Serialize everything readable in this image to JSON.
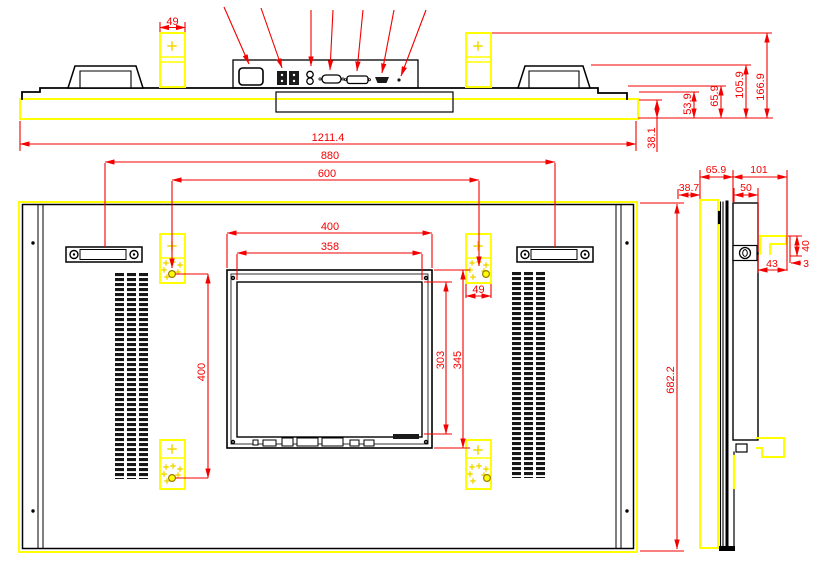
{
  "drawing": {
    "background": "#ffffff",
    "colors": {
      "outline": "#000000",
      "dimension": "#f40000",
      "highlight": "#ffff00"
    },
    "top_view": {
      "dims": {
        "bracket_width": "49",
        "overall_width": "1211.4",
        "bezel_depth": "38.1",
        "step_depth": "53.9",
        "panel_depth": "65.9",
        "handle_depth": "105.9",
        "mount_depth": "166.9"
      },
      "ports": [
        "power-inlet",
        "terminal-block",
        "terminal-block",
        "audio-jack",
        "audio-jack",
        "vga-port",
        "dvi-port",
        "hdmi-port",
        "indicator-dot"
      ]
    },
    "rear_view": {
      "dims": {
        "handle_pitch": "880",
        "vesa_horizontal": "600",
        "cutout_width": "400",
        "display_width": "358",
        "bracket_width": "49",
        "vesa_vertical": "400",
        "display_height": "303",
        "cutout_height": "345",
        "overall_height": "682.2"
      }
    },
    "side_view": {
      "dims": {
        "front_depth": "38.7",
        "body_depth": "65.9",
        "mount_depth": "101",
        "rail_width": "50",
        "hook_height": "40",
        "hook_width": "43",
        "hook_gap": "3"
      }
    }
  }
}
